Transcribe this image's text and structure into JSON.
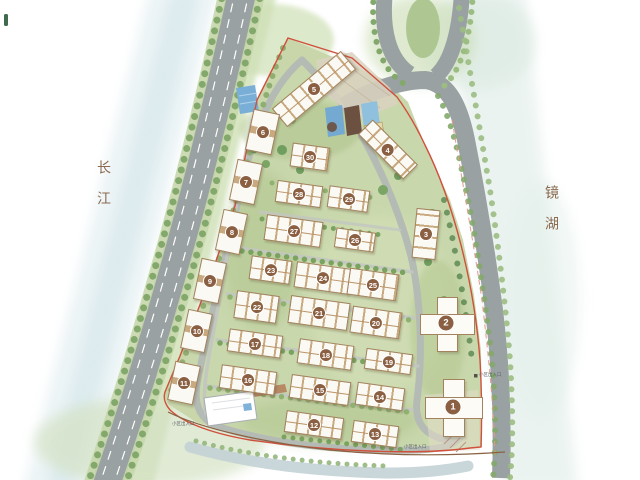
{
  "map": {
    "river_label": "长江",
    "lake_label": "镜湖",
    "entrance_label": "小区出入口"
  },
  "colors": {
    "boundary_red": "#d0503c",
    "boundary_brown": "#8a6242",
    "road_gray": "#9aa1a2",
    "site_green": "#c6d5a8",
    "tree_green": "#83a86b",
    "building_tan": "#a3825e",
    "badge_brown": "#8a5f42",
    "river_blue": "#d4e6ec",
    "lake_green_blue": "#dfece7",
    "pool_blue": "#74a9d1",
    "label_brown": "#8a6a50"
  },
  "buildings": [
    {
      "num": "1",
      "type": "tower",
      "x": 453,
      "y": 407,
      "w": 52,
      "h": 52,
      "rot": 0
    },
    {
      "num": "2",
      "type": "tower",
      "x": 446,
      "y": 323,
      "w": 50,
      "h": 50,
      "rot": 0
    },
    {
      "num": "3",
      "type": "tall",
      "x": 426,
      "y": 234,
      "w": 24,
      "h": 50,
      "rot": 6
    },
    {
      "num": "4",
      "type": "diag",
      "x": 388,
      "y": 149,
      "w": 64,
      "h": 21,
      "rot": 45
    },
    {
      "num": "5",
      "type": "slab",
      "x": 314,
      "y": 89,
      "w": 90,
      "h": 24,
      "rot": -40
    },
    {
      "num": "6",
      "type": "small",
      "x": 262,
      "y": 132,
      "w": 27,
      "h": 42,
      "rot": 12
    },
    {
      "num": "7",
      "type": "small",
      "x": 246,
      "y": 182,
      "w": 26,
      "h": 42,
      "rot": 12
    },
    {
      "num": "8",
      "type": "small",
      "x": 231,
      "y": 232,
      "w": 25,
      "h": 42,
      "rot": 12
    },
    {
      "num": "9",
      "type": "small",
      "x": 210,
      "y": 281,
      "w": 26,
      "h": 42,
      "rot": 12
    },
    {
      "num": "10",
      "type": "small",
      "x": 196,
      "y": 331,
      "w": 25,
      "h": 40,
      "rot": 12
    },
    {
      "num": "11",
      "type": "small",
      "x": 184,
      "y": 383,
      "w": 26,
      "h": 40,
      "rot": 12
    },
    {
      "num": "12",
      "type": "slab",
      "x": 314,
      "y": 425,
      "w": 58,
      "h": 22,
      "rot": 8
    },
    {
      "num": "13",
      "type": "slab",
      "x": 375,
      "y": 434,
      "w": 46,
      "h": 22,
      "rot": 8
    },
    {
      "num": "14",
      "type": "slab",
      "x": 380,
      "y": 396,
      "w": 48,
      "h": 23,
      "rot": 8
    },
    {
      "num": "15",
      "type": "slab",
      "x": 320,
      "y": 390,
      "w": 60,
      "h": 24,
      "rot": 8
    },
    {
      "num": "16",
      "type": "slab",
      "x": 248,
      "y": 380,
      "w": 56,
      "h": 24,
      "rot": 8
    },
    {
      "num": "17",
      "type": "slab",
      "x": 255,
      "y": 343,
      "w": 54,
      "h": 23,
      "rot": 8
    },
    {
      "num": "18",
      "type": "slab",
      "x": 325,
      "y": 354,
      "w": 55,
      "h": 25,
      "rot": 8
    },
    {
      "num": "19",
      "type": "slab",
      "x": 388,
      "y": 361,
      "w": 47,
      "h": 21,
      "rot": 8
    },
    {
      "num": "20",
      "type": "slab",
      "x": 376,
      "y": 322,
      "w": 50,
      "h": 27,
      "rot": 8
    },
    {
      "num": "21",
      "type": "slab",
      "x": 319,
      "y": 313,
      "w": 60,
      "h": 28,
      "rot": 8
    },
    {
      "num": "22",
      "type": "slab",
      "x": 256,
      "y": 307,
      "w": 43,
      "h": 28,
      "rot": 8
    },
    {
      "num": "23",
      "type": "slab",
      "x": 270,
      "y": 270,
      "w": 41,
      "h": 24,
      "rot": 8
    },
    {
      "num": "24",
      "type": "slab",
      "x": 322,
      "y": 278,
      "w": 55,
      "h": 26,
      "rot": 8
    },
    {
      "num": "25",
      "type": "slab",
      "x": 373,
      "y": 284,
      "w": 50,
      "h": 27,
      "rot": 8
    },
    {
      "num": "26",
      "type": "slab",
      "x": 355,
      "y": 240,
      "w": 40,
      "h": 20,
      "rot": 8
    },
    {
      "num": "27",
      "type": "slab",
      "x": 293,
      "y": 231,
      "w": 57,
      "h": 26,
      "rot": 8
    },
    {
      "num": "28",
      "type": "slab",
      "x": 299,
      "y": 194,
      "w": 46,
      "h": 22,
      "rot": 8
    },
    {
      "num": "29",
      "type": "slab",
      "x": 348,
      "y": 199,
      "w": 41,
      "h": 22,
      "rot": 8
    },
    {
      "num": "30",
      "type": "slab",
      "x": 310,
      "y": 157,
      "w": 38,
      "h": 24,
      "rot": 8
    }
  ]
}
